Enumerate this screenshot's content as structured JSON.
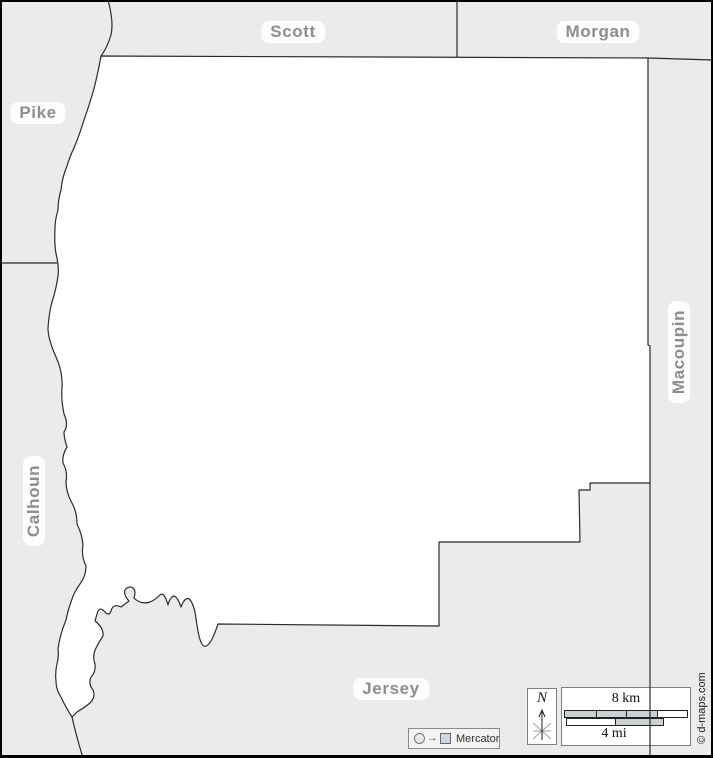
{
  "map": {
    "region_labels": [
      {
        "id": "scott",
        "label": "Scott"
      },
      {
        "id": "morgan",
        "label": "Morgan"
      },
      {
        "id": "pike",
        "label": "Pike"
      },
      {
        "id": "calhoun",
        "label": "Calhoun"
      },
      {
        "id": "macoupin",
        "label": "Macoupin"
      },
      {
        "id": "jersey",
        "label": "Jersey"
      }
    ],
    "colors": {
      "surrounding_fill": "#ebebeb",
      "county_fill": "#ffffff",
      "boundary_line": "#2b2b2b",
      "label_text": "#8e8e8e",
      "label_halo": "#ffffff",
      "scale_segment_gray": "#cbd0d2",
      "frame": "#000000"
    }
  },
  "compass": {
    "north_label": "N"
  },
  "scale": {
    "km_label": "8 km",
    "mi_label": "4 mi"
  },
  "projection": {
    "label": "Mercator",
    "arrow_glyph": "→"
  },
  "copyright": {
    "text": "© d-maps.com"
  }
}
